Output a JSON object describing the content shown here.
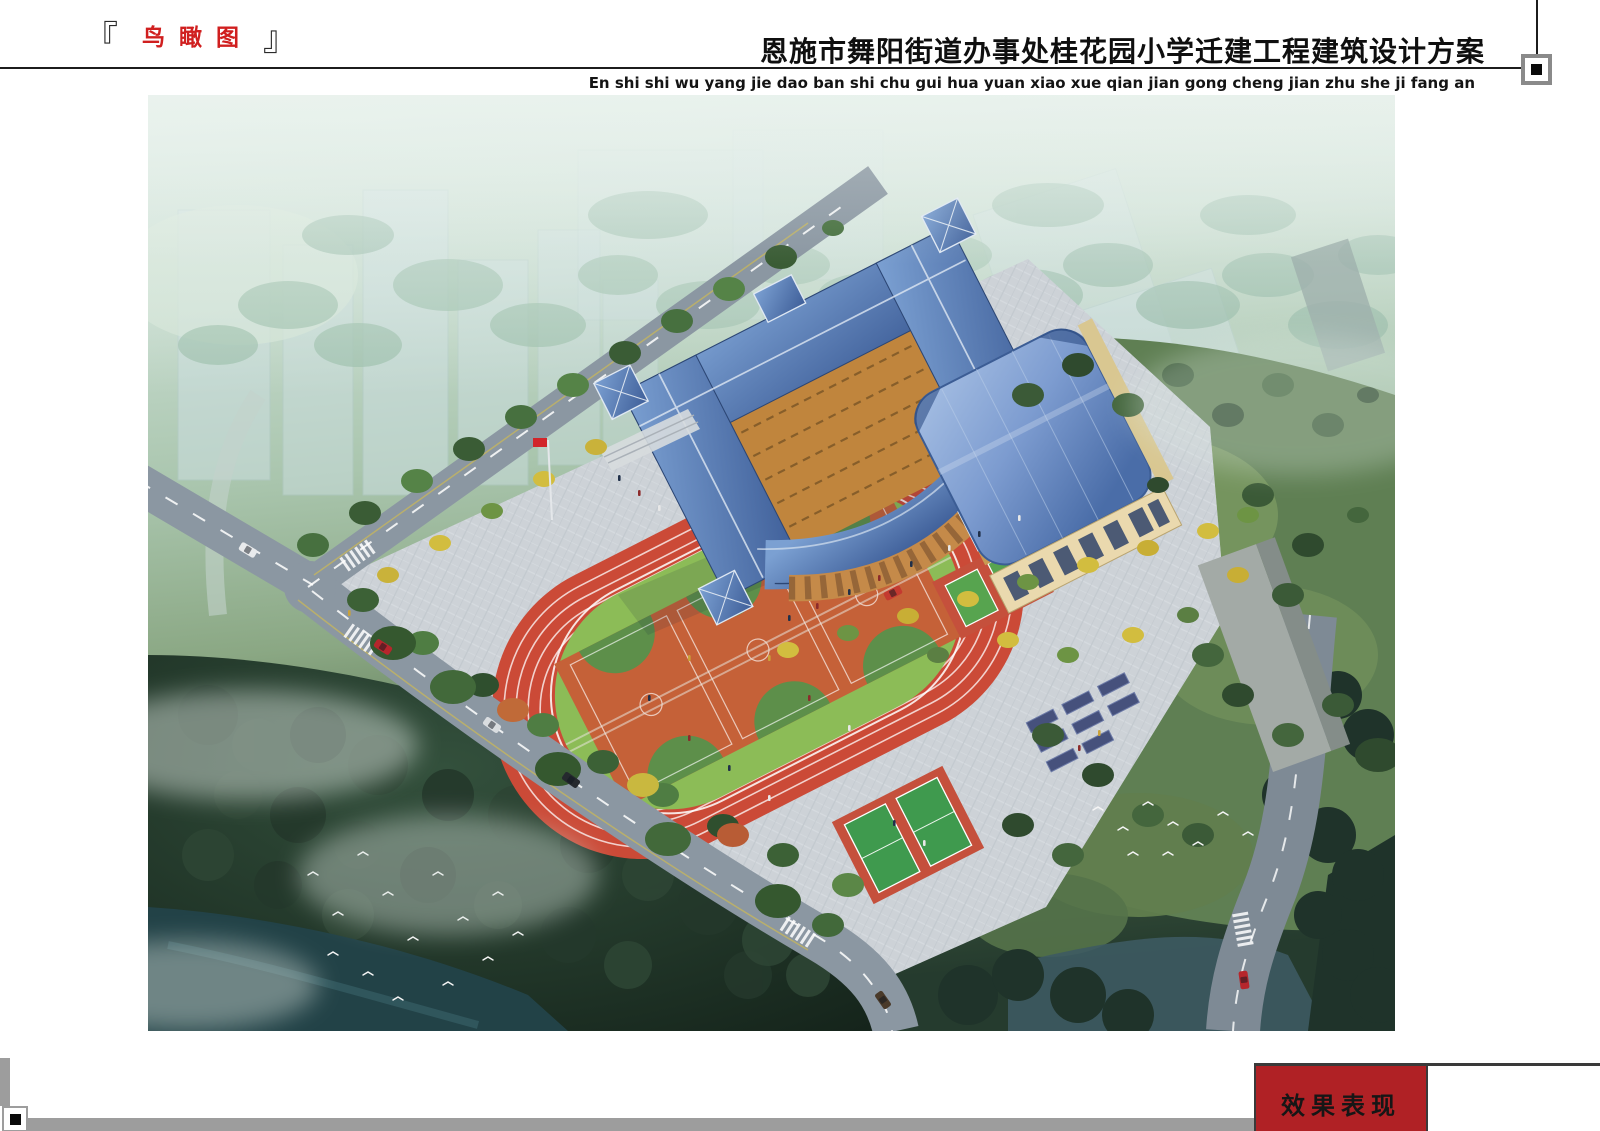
{
  "header": {
    "bracket_left": "『",
    "bracket_right": "』",
    "view_label": "鸟瞰图",
    "project_title": "恩施市舞阳街道办事处桂花园小学迁建工程建筑设计方案",
    "project_title_pinyin": "En shi shi wu yang jie dao ban shi chu gui hua yuan xiao xue qian jian gong cheng jian zhu she ji fang an",
    "colors": {
      "view_label_red": "#d01f1f",
      "rule_black": "#1c1c1c",
      "marker_gray": "#8a8a8a"
    }
  },
  "footer": {
    "effect_tag_label": "效果表现",
    "colors": {
      "tag_red": "#b02125",
      "tag_border": "#3a3a3a",
      "bar_gray": "#9d9d9d"
    }
  },
  "render": {
    "palette": {
      "mist_green": "#cfe3da",
      "track_red": "#cb4a37",
      "infield_green": "#8cbc57",
      "court_orange": "#c56138",
      "court_green": "#5d8f4a",
      "roof_blue": "#5b7fb4",
      "gym_roof_blue": "#8fa9d6",
      "wall_tan": "#c99a52",
      "plaza_gray": "#cdd3d8",
      "road_gray": "#8b97a2",
      "forest_dark": "#22372a",
      "water_teal": "#24464b",
      "ginkgo_yellow": "#d2bd3f",
      "flag_red": "#d2242a"
    }
  }
}
